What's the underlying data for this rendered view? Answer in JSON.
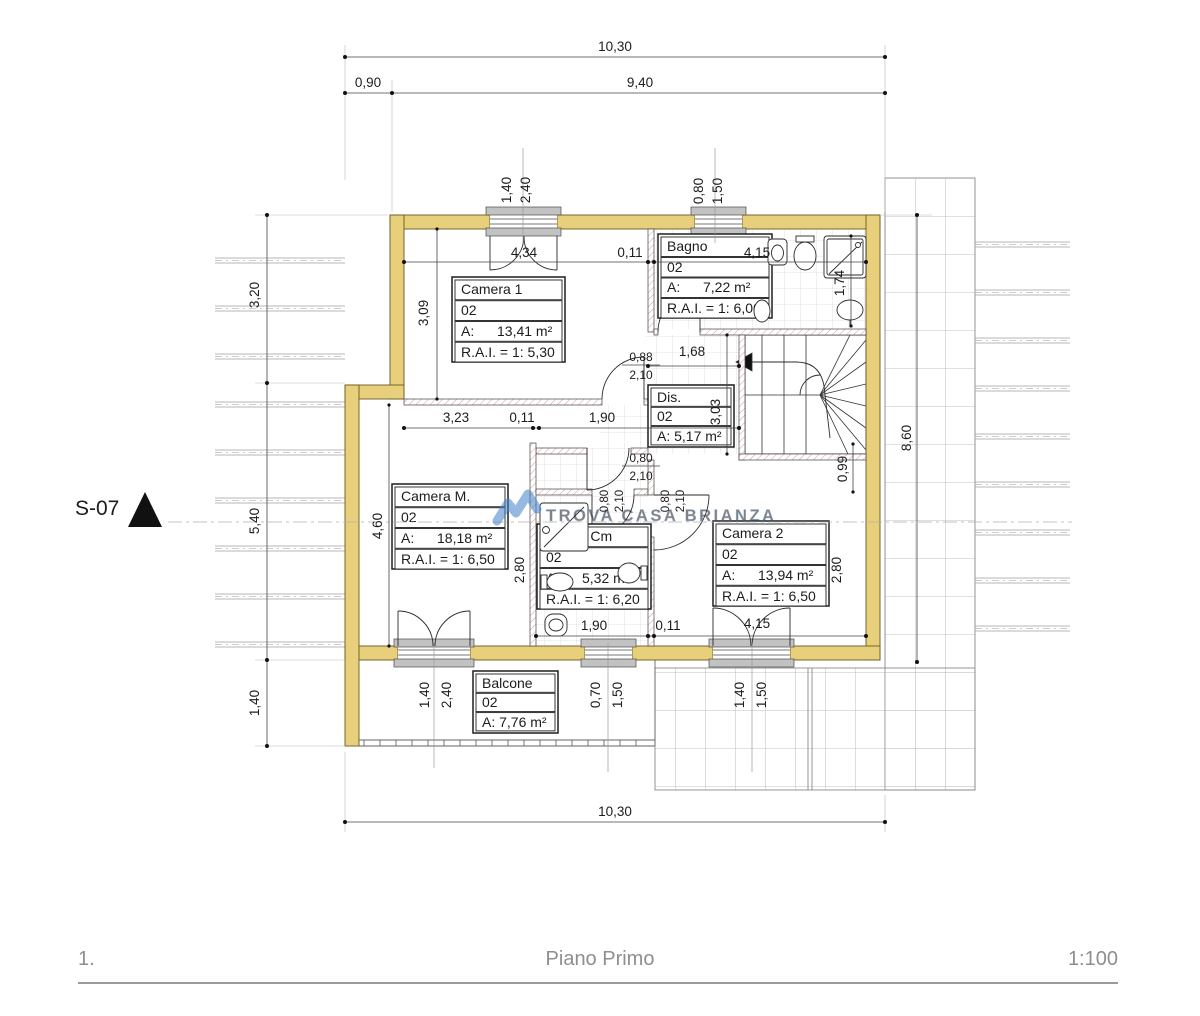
{
  "meta": {
    "page_number": "1.",
    "plan_title": "Piano Primo",
    "scale": "1:100"
  },
  "section_marker": {
    "label": "S-07"
  },
  "watermark": {
    "text": "TROVA CASA BRIANZA"
  },
  "rooms": [
    {
      "name": "Camera 1",
      "level": "02",
      "area_label": "A:",
      "area_value": "13,41 m²",
      "rai": "R.A.I. = 1: 5,30"
    },
    {
      "name": "Bagno",
      "level": "02",
      "area_label": "A:",
      "area_value": "7,22 m²",
      "rai": "R.A.I. = 1: 6,00"
    },
    {
      "name": "Dis.",
      "level": "02",
      "area_row": "A: 5,17 m²"
    },
    {
      "name": "Camera M.",
      "level": "02",
      "area_label": "A:",
      "area_value": "18,18 m²",
      "rai": "R.A.I. = 1: 6,50"
    },
    {
      "name": "Bagno Cm",
      "level": "02",
      "area_label": "A:",
      "area_value": "5,32 m²",
      "rai": "R.A.I. = 1: 6,20"
    },
    {
      "name": "Camera 2",
      "level": "02",
      "area_label": "A:",
      "area_value": "13,94 m²",
      "rai": "R.A.I. = 1: 6,50"
    },
    {
      "name": "Balcone",
      "level": "02",
      "area_row": "A: 7,76 m²"
    }
  ],
  "dims": {
    "top_total": "10,30",
    "top_left": "0,90",
    "top_right": "9,40",
    "top_win1_w": "1,40",
    "top_win1_h": "2,40",
    "top_win2_w": "0,80",
    "top_win2_h": "1,50",
    "upper_row_a": "4,34",
    "upper_row_b": "0,11",
    "upper_row_c": "4,15",
    "camera1_depth": "3,09",
    "shower_width": "1,74",
    "door_camera1_w": "0,88",
    "door_camera1_h": "2,10",
    "hall_width": "1,68",
    "dis_depth": "3,03",
    "mid_row_a": "3,23",
    "mid_row_b": "0,11",
    "mid_row_c": "1,90",
    "door_vest_w": "0,80",
    "door_vest_h": "2,10",
    "cameraM_depth": "4,60",
    "stair_offset": "0,99",
    "bagnocm_depth": "2,80",
    "camera2_depth": "2,80",
    "door_bagnocm_w": "0,80",
    "door_bagnocm_h": "2,10",
    "door_camera2_w": "0,80",
    "door_camera2_h": "2,10",
    "lower_row_a": "1,90",
    "lower_row_b": "0,11",
    "lower_row_c": "4,15",
    "bot_win1_w": "1,40",
    "bot_win1_h": "2,40",
    "bot_win2_w": "0,70",
    "bot_win2_h": "1,50",
    "bot_win3_w": "1,40",
    "bot_win3_h": "1,50",
    "left_a": "3,20",
    "left_b": "5,40",
    "left_c": "1,40",
    "right_total": "8,60",
    "bottom_total": "10,30"
  }
}
